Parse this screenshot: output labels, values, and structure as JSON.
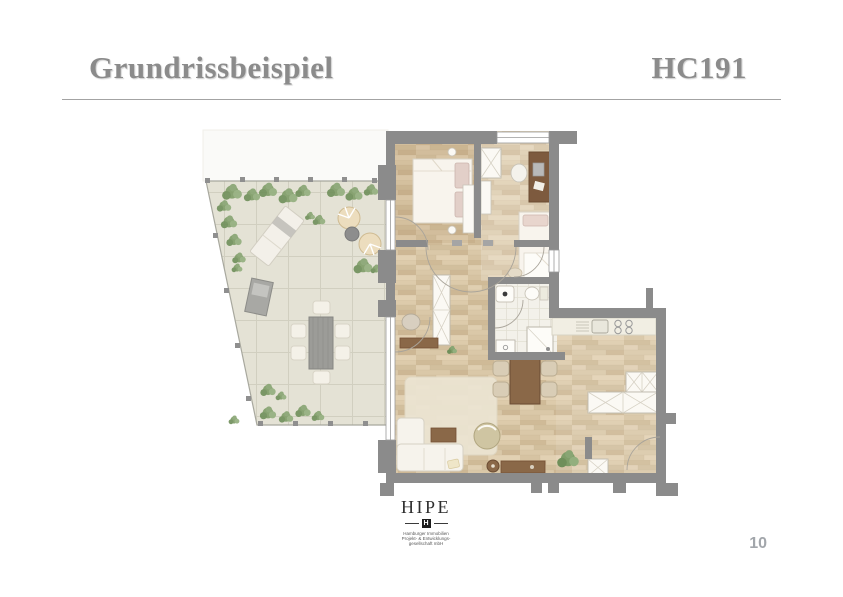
{
  "header": {
    "title": "Grundrissbeispiel",
    "code": "HC191",
    "text_color": "#8b8b8b"
  },
  "footer": {
    "page_number": "10",
    "page_number_color": "#a2a6ab"
  },
  "logo": {
    "wordmark": "HIPE",
    "monogram": "H",
    "sub_lines": [
      "Hamburger Immobilien",
      "Projekt- & Entwicklungs-",
      "gesellschaft mbH"
    ]
  },
  "floor_plan": {
    "description": "Apartment floor plan with bedroom, office, second bedroom, bathroom, open living-dining-kitchen area and a large tiled terrace with outdoor furniture",
    "colors": {
      "wall": "#8b8b8b",
      "wood_floor": "#d8c6a6",
      "terrace_tile": "#e4e2d5",
      "bathroom_tile": "#f3f1ea",
      "plants": "#7f9d68",
      "furniture_wood": "#8a6848",
      "furniture_white": "#f6f3ec"
    }
  }
}
